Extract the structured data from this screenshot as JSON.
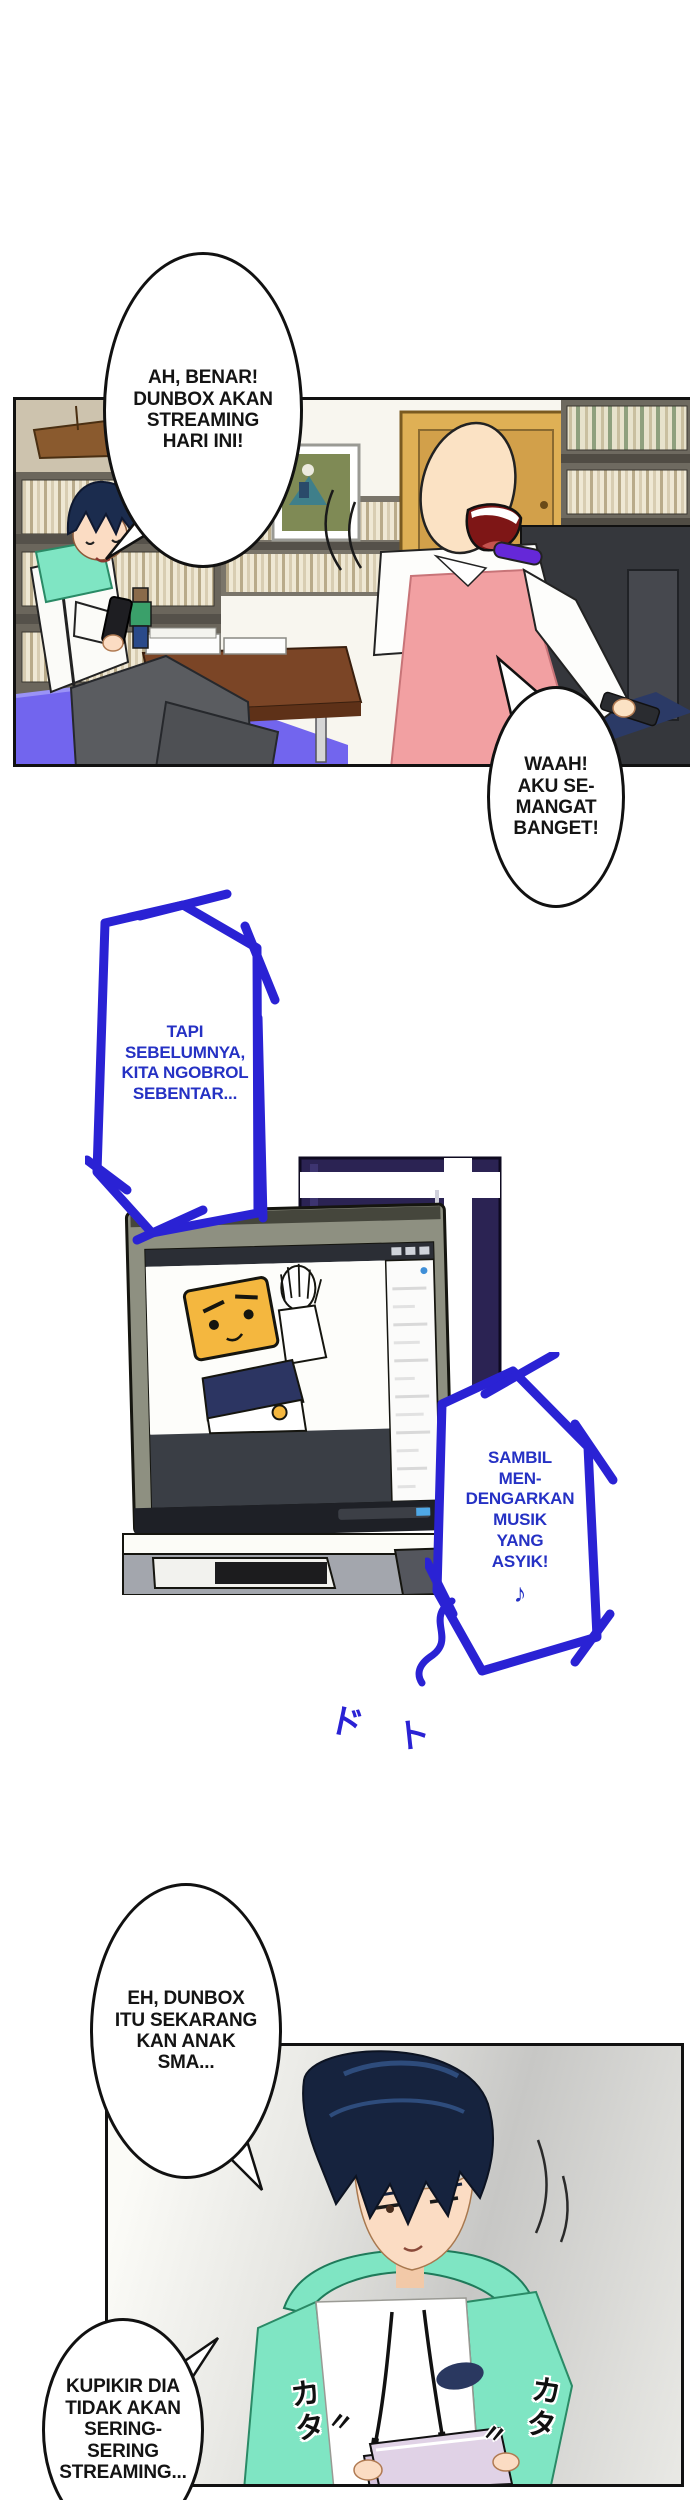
{
  "meta": {
    "kind": "webtoon-comic-page",
    "language": "Indonesian"
  },
  "colors": {
    "marker_blue": "#2a22d4",
    "marker_text_blue": "#2531c4",
    "hoodie_mint": "#7fe5c3",
    "hair_navy": "#16233e",
    "dress_pink": "#f2a0a2",
    "choker_purple": "#6528d8",
    "door_tan": "#dfb055",
    "window_frame_purple": "#2b2353",
    "monitor_bezel_olive": "#8e9081",
    "boxhead_yellow": "#f4b73f",
    "papers_lavender": "#e0d2e6",
    "floor_mat_purple": "#7265ee",
    "table_wood": "#7b4526"
  },
  "panel_room": {
    "bubble_boy_lines": [
      "AH, BENAR!",
      "DUNBOX AKAN",
      "STREAMING",
      "HARI INI!"
    ],
    "bubble_woman_lines": [
      "WAAH!",
      "AKU SE-",
      "MANGAT",
      "BANGET!"
    ]
  },
  "interlude": {
    "bubble_intro_lines": [
      "TAPI",
      "SEBELUMNYA,",
      "KITA NGOBROL",
      "SEBENTAR..."
    ],
    "bubble_music_lines": [
      "SAMBIL",
      "MEN-",
      "DENGARKAN",
      "MUSIK",
      "YANG",
      "ASYIK!"
    ],
    "music_note": "♪",
    "scribble_1": "ド",
    "scribble_2": "ト"
  },
  "panel_desk": {
    "bubble_school_lines": [
      "EH, DUNBOX",
      "ITU SEKARANG",
      "KAN ANAK",
      "SMA..."
    ],
    "bubble_thought_lines": [
      "KUPIKIR DIA",
      "TIDAK AKAN",
      "SERING-",
      "SERING",
      "STREAMING..."
    ],
    "sfx_typing_left": "カタ",
    "sfx_typing_right": "カタ",
    "sfx_ditto_left": "〃",
    "sfx_ditto_right": "〃"
  }
}
